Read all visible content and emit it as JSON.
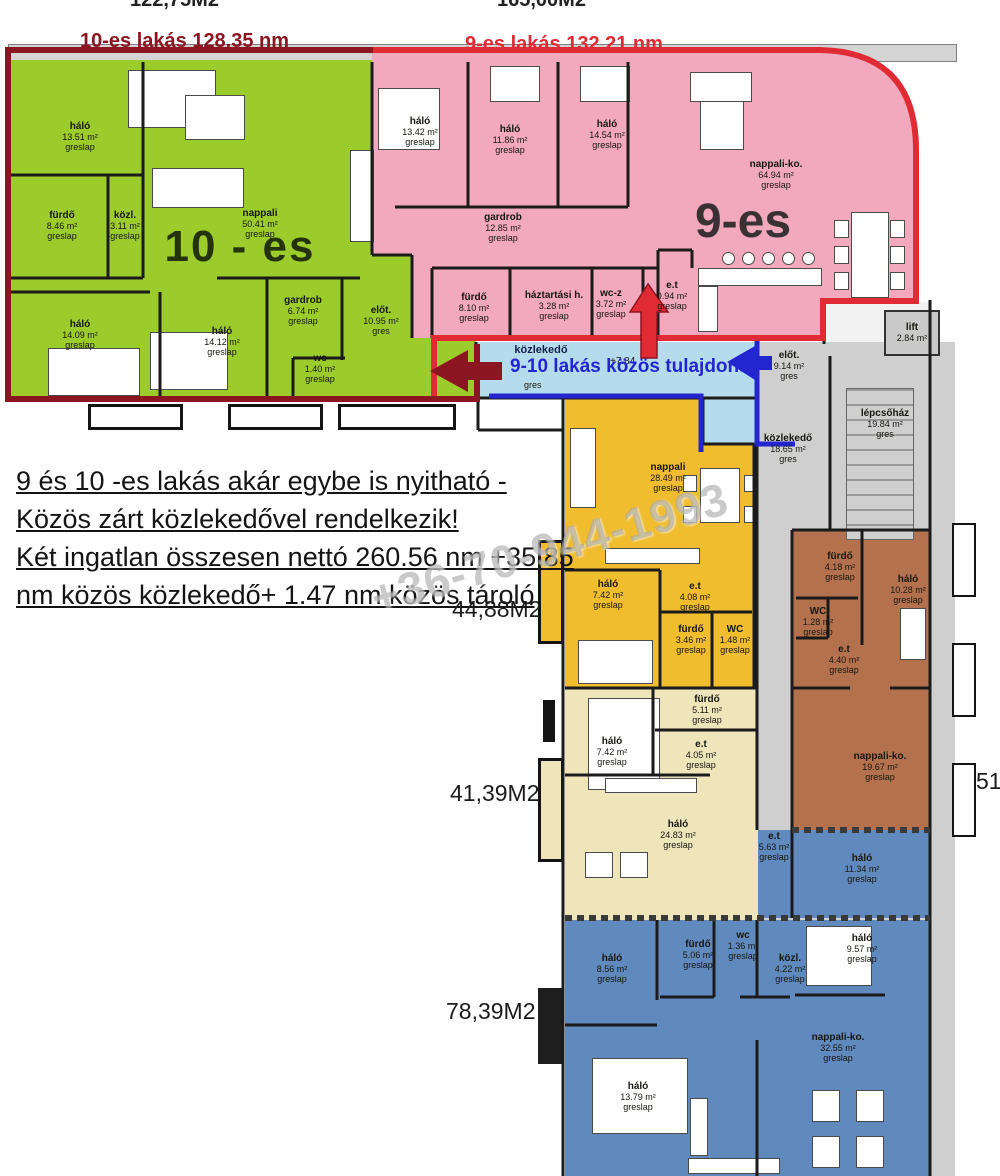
{
  "top_labels": {
    "left": "122,75M2",
    "right": "165,00M2"
  },
  "headers": {
    "apt10": "10-es lakás 128.35 nm",
    "apt9": "9-es lakás 132.21 nm"
  },
  "apartments": {
    "apt10": {
      "big_label": "10 - es",
      "rooms": [
        {
          "name": "háló",
          "area": "13.51 m²",
          "floor": "greslap"
        },
        {
          "name": "fürdő",
          "area": "8.46 m²",
          "floor": "greslap"
        },
        {
          "name": "közl.",
          "area": "3.11 m²",
          "floor": "greslap"
        },
        {
          "name": "nappali",
          "area": "50.41 m²",
          "floor": "greslap"
        },
        {
          "name": "gardrob",
          "area": "6.74 m²",
          "floor": "greslap"
        },
        {
          "name": "előt.",
          "area": "10.95 m²",
          "floor": "gres"
        },
        {
          "name": "háló",
          "area": "14.09 m²",
          "floor": "greslap"
        },
        {
          "name": "háló",
          "area": "14.12 m²",
          "floor": "greslap"
        },
        {
          "name": "wc",
          "area": "1.40 m²",
          "floor": "greslap"
        }
      ]
    },
    "apt9": {
      "big_label": "9-es",
      "rooms": [
        {
          "name": "háló",
          "area": "13.42 m²",
          "floor": "greslap"
        },
        {
          "name": "háló",
          "area": "11.86 m²",
          "floor": "greslap"
        },
        {
          "name": "háló",
          "area": "14.54 m²",
          "floor": "greslap"
        },
        {
          "name": "gardrob",
          "area": "12.85 m²",
          "floor": "greslap"
        },
        {
          "name": "fürdő",
          "area": "8.10 m²",
          "floor": "greslap"
        },
        {
          "name": "háztartási h.",
          "area": "3.28 m²",
          "floor": "greslap"
        },
        {
          "name": "wc-z",
          "area": "3.72 m²",
          "floor": "greslap"
        },
        {
          "name": "e.t",
          "area": "0.94 m²",
          "floor": "greslap"
        },
        {
          "name": "nappali-ko.",
          "area": "64.94 m²",
          "floor": "greslap"
        }
      ]
    },
    "apt_yellow": {
      "rooms": [
        {
          "name": "nappali",
          "area": "28.49 m²",
          "floor": "greslap"
        },
        {
          "name": "háló",
          "area": "7.42 m²",
          "floor": "greslap"
        },
        {
          "name": "e.t",
          "area": "4.08 m²",
          "floor": "greslap"
        },
        {
          "name": "fürdő",
          "area": "3.46 m²",
          "floor": "greslap"
        },
        {
          "name": "WC",
          "area": "1.48 m²",
          "floor": "greslap"
        }
      ]
    },
    "apt_cream": {
      "rooms": [
        {
          "name": "fürdő",
          "area": "5.11 m²",
          "floor": "greslap"
        },
        {
          "name": "háló",
          "area": "7.42 m²",
          "floor": "greslap"
        },
        {
          "name": "e.t",
          "area": "4.05 m²",
          "floor": "greslap"
        },
        {
          "name": "háló",
          "area": "24.83 m²",
          "floor": "greslap"
        }
      ]
    },
    "apt_brown": {
      "rooms": [
        {
          "name": "fürdő",
          "area": "4.18 m²",
          "floor": "greslap"
        },
        {
          "name": "WC",
          "area": "1.28 m²",
          "floor": "greslap"
        },
        {
          "name": "háló",
          "area": "10.28 m²",
          "floor": "greslap"
        },
        {
          "name": "e.t",
          "area": "4.40 m²",
          "floor": "greslap"
        },
        {
          "name": "nappali-ko.",
          "area": "19.67 m²",
          "floor": "greslap"
        }
      ]
    },
    "apt_blue": {
      "rooms": [
        {
          "name": "háló",
          "area": "8.56 m²",
          "floor": "greslap"
        },
        {
          "name": "fürdő",
          "area": "5.06 m²",
          "floor": "greslap"
        },
        {
          "name": "wc",
          "area": "1.36 m²",
          "floor": "greslap"
        },
        {
          "name": "közl.",
          "area": "4.22 m²",
          "floor": "greslap"
        },
        {
          "name": "e.t",
          "area": "5.63 m²",
          "floor": "greslap"
        },
        {
          "name": "háló",
          "area": "11.34 m²",
          "floor": "greslap"
        },
        {
          "name": "háló",
          "area": "9.57 m²",
          "floor": "greslap"
        },
        {
          "name": "nappali-ko.",
          "area": "32.55 m²",
          "floor": "greslap"
        },
        {
          "name": "háló",
          "area": "13.79 m²",
          "floor": "greslap"
        }
      ]
    }
  },
  "common": {
    "corridor_name": "közlekedő",
    "corridor_level": "+7.84",
    "corridor_floor": "gres",
    "annotation": "9-10 lakás közös tulajdona",
    "rooms": [
      {
        "name": "lift",
        "area": "2.84 m²",
        "floor": ""
      },
      {
        "name": "lépcsőház",
        "area": "19.84 m²",
        "floor": "gres"
      },
      {
        "name": "közlekedő",
        "area": "18.65 m²",
        "floor": "gres"
      },
      {
        "name": "előt.",
        "area": "9.14 m²",
        "floor": "gres"
      }
    ]
  },
  "notes": {
    "line1": "9 és 10 -es lakás akár egybe is nyitható -",
    "line2": "Közös zárt közlekedővel rendelkezik!",
    "line3": "Két ingatlan összesen nettó 260.56 nm +35.85",
    "line4": "nm közös közlekedő+ 1.47 nm közös tároló"
  },
  "area_labels": {
    "yellow": "44,88M2",
    "cream": "41,39M2",
    "blue": "78,39M2",
    "right_partial": "51"
  },
  "watermark": "+36-70-944-1993",
  "colors": {
    "apt10": "#9ccb2c",
    "apt9": "#f2a9bd",
    "corridor": "#b5dcec",
    "apt_yellow": "#f0bd2e",
    "apt_cream": "#eee5bb",
    "apt_blue": "#6089bd",
    "apt_brown": "#b4714e",
    "gray": "#cfcfcf",
    "outline_apt10": "#8c1522",
    "outline_apt9": "#e02b35",
    "annotation_blue": "#2326cf"
  }
}
